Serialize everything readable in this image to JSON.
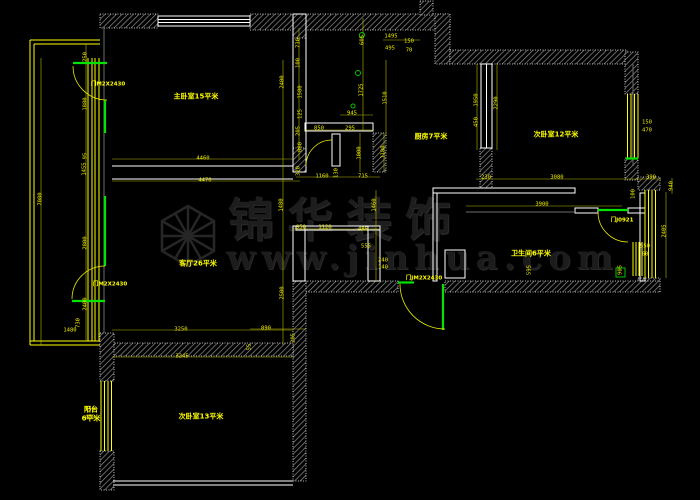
{
  "watermark": {
    "brand": "锦华装饰",
    "url": "www.jinhua.com",
    "color": "#1d1d1d"
  },
  "colors": {
    "background": "#000000",
    "dimension_text": "#f0f000",
    "dimension_line": "#b8b800",
    "wall_hatch": "#8f8f8f",
    "wall_edge": "#f0f0f0",
    "window_line": "#ffff00",
    "door_green": "#00e400",
    "white_line": "#ffffff"
  },
  "plan": {
    "room_labels": [
      {
        "t": "主卧室15平米",
        "x": 196,
        "y": 97
      },
      {
        "t": "厨房7平米",
        "x": 431,
        "y": 137
      },
      {
        "t": "次卧室12平米",
        "x": 556,
        "y": 135
      },
      {
        "t": "客厅26平米",
        "x": 198,
        "y": 264
      },
      {
        "t": "次卧室13平米",
        "x": 201,
        "y": 417
      },
      {
        "t": "卫生间6平米",
        "x": 531,
        "y": 254
      },
      {
        "t": "阳台",
        "x": 91,
        "y": 410
      },
      {
        "t": "6平米",
        "x": 91,
        "y": 419
      }
    ],
    "door_labels": [
      {
        "t": "门M2X2430",
        "x": 108,
        "y": 85
      },
      {
        "t": "门M2X2430",
        "x": 110,
        "y": 285
      },
      {
        "t": "门JM2X2430",
        "x": 424,
        "y": 279
      },
      {
        "t": "门J0921",
        "x": 622,
        "y": 221
      }
    ],
    "dimensions": [
      {
        "t": "4460",
        "x": 203,
        "y": 159
      },
      {
        "t": "4470",
        "x": 205,
        "y": 181
      },
      {
        "t": "3250",
        "x": 181,
        "y": 330
      },
      {
        "t": "3245",
        "x": 182,
        "y": 357
      },
      {
        "t": "890",
        "x": 266,
        "y": 329
      },
      {
        "t": "205",
        "x": 294,
        "y": 338,
        "r": 90
      },
      {
        "t": "55",
        "x": 250,
        "y": 347,
        "r": 90
      },
      {
        "t": "7080",
        "x": 41,
        "y": 199,
        "r": 90
      },
      {
        "t": "250",
        "x": 86,
        "y": 57,
        "r": 90
      },
      {
        "t": "1880",
        "x": 86,
        "y": 104,
        "r": 90
      },
      {
        "t": "95",
        "x": 86,
        "y": 156,
        "r": 90
      },
      {
        "t": "1455",
        "x": 85,
        "y": 169,
        "r": 90
      },
      {
        "t": "2800",
        "x": 86,
        "y": 243,
        "r": 90
      },
      {
        "t": "2400",
        "x": 86,
        "y": 304,
        "r": 90
      },
      {
        "t": "730",
        "x": 79,
        "y": 323,
        "r": 90
      },
      {
        "t": "1480",
        "x": 70,
        "y": 331
      },
      {
        "t": "150",
        "x": 90,
        "y": 410
      },
      {
        "t": "470",
        "x": 90,
        "y": 418
      },
      {
        "t": "2400",
        "x": 283,
        "y": 82,
        "r": 90
      },
      {
        "t": "730",
        "x": 299,
        "y": 43,
        "r": 90
      },
      {
        "t": "100",
        "x": 299,
        "y": 63,
        "r": 90
      },
      {
        "t": "1580",
        "x": 301,
        "y": 92,
        "r": 90
      },
      {
        "t": "125",
        "x": 301,
        "y": 114,
        "r": 90
      },
      {
        "t": "205",
        "x": 299,
        "y": 131,
        "r": 90
      },
      {
        "t": "880",
        "x": 301,
        "y": 147,
        "r": 90
      },
      {
        "t": "605",
        "x": 363,
        "y": 40,
        "r": 90
      },
      {
        "t": "1725",
        "x": 362,
        "y": 90,
        "r": 90
      },
      {
        "t": "1510",
        "x": 386,
        "y": 98,
        "r": 90
      },
      {
        "t": "945",
        "x": 352,
        "y": 114
      },
      {
        "t": "850",
        "x": 319,
        "y": 129
      },
      {
        "t": "295",
        "x": 350,
        "y": 129
      },
      {
        "t": "1000",
        "x": 360,
        "y": 153,
        "r": 90
      },
      {
        "t": "1180",
        "x": 384,
        "y": 152,
        "r": 90
      },
      {
        "t": "1495",
        "x": 391,
        "y": 37
      },
      {
        "t": "495",
        "x": 390,
        "y": 49
      },
      {
        "t": "150",
        "x": 409,
        "y": 42
      },
      {
        "t": "70",
        "x": 409,
        "y": 51
      },
      {
        "t": "320",
        "x": 299,
        "y": 171,
        "r": 90
      },
      {
        "t": "1160",
        "x": 322,
        "y": 177
      },
      {
        "t": "130",
        "x": 337,
        "y": 173,
        "r": 90
      },
      {
        "t": "715",
        "x": 363,
        "y": 177
      },
      {
        "t": "1480",
        "x": 282,
        "y": 205,
        "r": 90
      },
      {
        "t": "1460",
        "x": 375,
        "y": 205,
        "r": 90
      },
      {
        "t": "950",
        "x": 301,
        "y": 228
      },
      {
        "t": "1120",
        "x": 325,
        "y": 228
      },
      {
        "t": "485",
        "x": 363,
        "y": 230
      },
      {
        "t": "555",
        "x": 366,
        "y": 247
      },
      {
        "t": "2500",
        "x": 283,
        "y": 293,
        "r": 90
      },
      {
        "t": "240",
        "x": 383,
        "y": 261
      },
      {
        "t": "140",
        "x": 383,
        "y": 268
      },
      {
        "t": "1950",
        "x": 477,
        "y": 100,
        "r": 90
      },
      {
        "t": "450",
        "x": 477,
        "y": 122,
        "r": 90
      },
      {
        "t": "2290",
        "x": 497,
        "y": 103,
        "r": 90
      },
      {
        "t": "150",
        "x": 647,
        "y": 123
      },
      {
        "t": "470",
        "x": 647,
        "y": 131
      },
      {
        "t": "230",
        "x": 486,
        "y": 178
      },
      {
        "t": "3080",
        "x": 557,
        "y": 178
      },
      {
        "t": "390",
        "x": 651,
        "y": 178
      },
      {
        "t": "940",
        "x": 672,
        "y": 186,
        "r": 90
      },
      {
        "t": "100",
        "x": 634,
        "y": 194,
        "r": 90
      },
      {
        "t": "3900",
        "x": 542,
        "y": 205
      },
      {
        "t": "2405",
        "x": 665,
        "y": 231,
        "r": 90
      },
      {
        "t": "595",
        "x": 530,
        "y": 270,
        "r": 90
      },
      {
        "t": "905",
        "x": 621,
        "y": 270,
        "r": 90
      },
      {
        "t": "550",
        "x": 645,
        "y": 247
      },
      {
        "t": "60",
        "x": 645,
        "y": 255
      }
    ]
  }
}
